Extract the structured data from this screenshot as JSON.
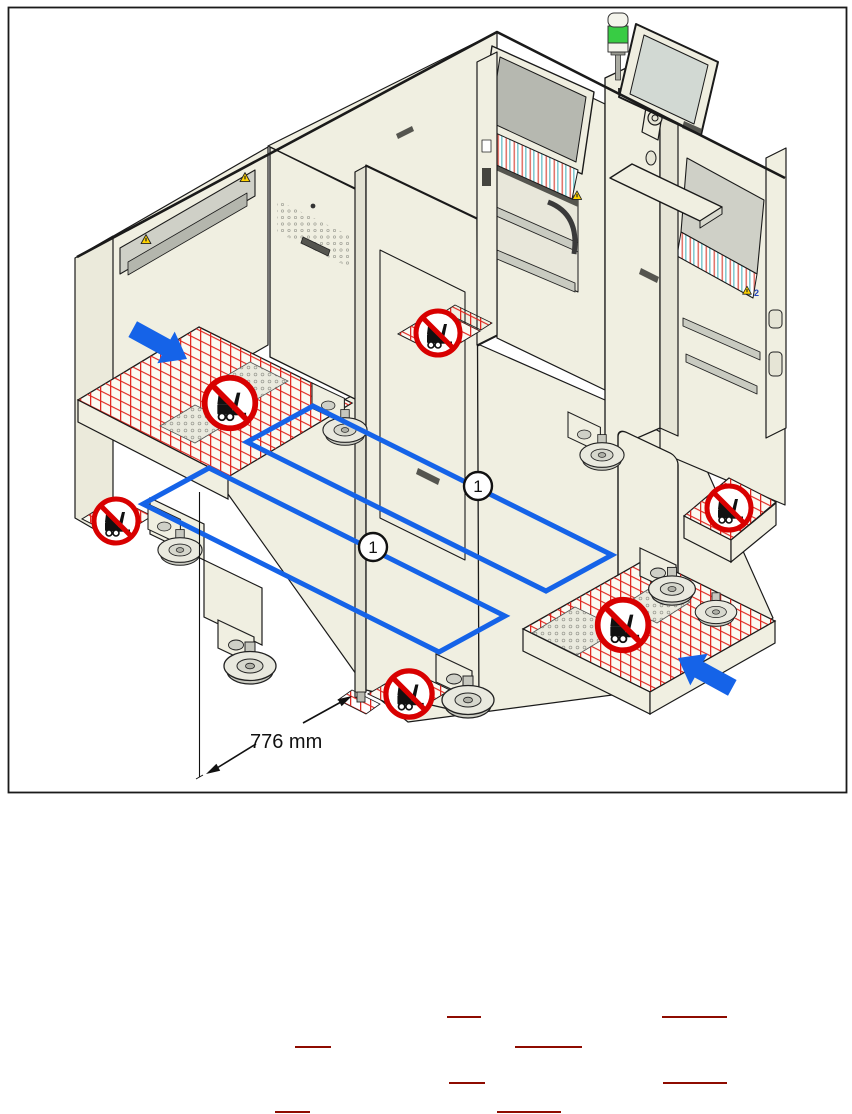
{
  "figure": {
    "type": "machine-transport-diagram",
    "dimension_label": "776 mm",
    "callouts": [
      "1",
      "1"
    ],
    "feeder_badge": "2",
    "icons": [
      "forklift-prohibited-icon",
      "warning-triangle-icon",
      "signal-tower-icon",
      "monitor-icon",
      "direction-arrow-icon",
      "caster-foot-icon"
    ],
    "colors": {
      "machine_body": "#F0EFE1",
      "machine_shade": "#E4E3D4",
      "panel_gray": "#CFD0C7",
      "screen_gray": "#B6B8B0",
      "accent_blue": "#1563E8",
      "hazard_red": "#E0251E",
      "prohibition_red": "#D80000",
      "warning_yellow": "#FFD200",
      "lamp_green": "#38CC44",
      "frame_border": "#1A1A1A"
    }
  },
  "footer": {
    "underline_color": "#8E0B00",
    "underlines": [
      {
        "x": 447,
        "y": 1016,
        "w": 34
      },
      {
        "x": 662,
        "y": 1016,
        "w": 65
      },
      {
        "x": 295,
        "y": 1046,
        "w": 36
      },
      {
        "x": 515,
        "y": 1046,
        "w": 67
      },
      {
        "x": 449,
        "y": 1082,
        "w": 36
      },
      {
        "x": 663,
        "y": 1082,
        "w": 64
      },
      {
        "x": 275,
        "y": 1111,
        "w": 35
      },
      {
        "x": 497,
        "y": 1111,
        "w": 64
      }
    ]
  }
}
